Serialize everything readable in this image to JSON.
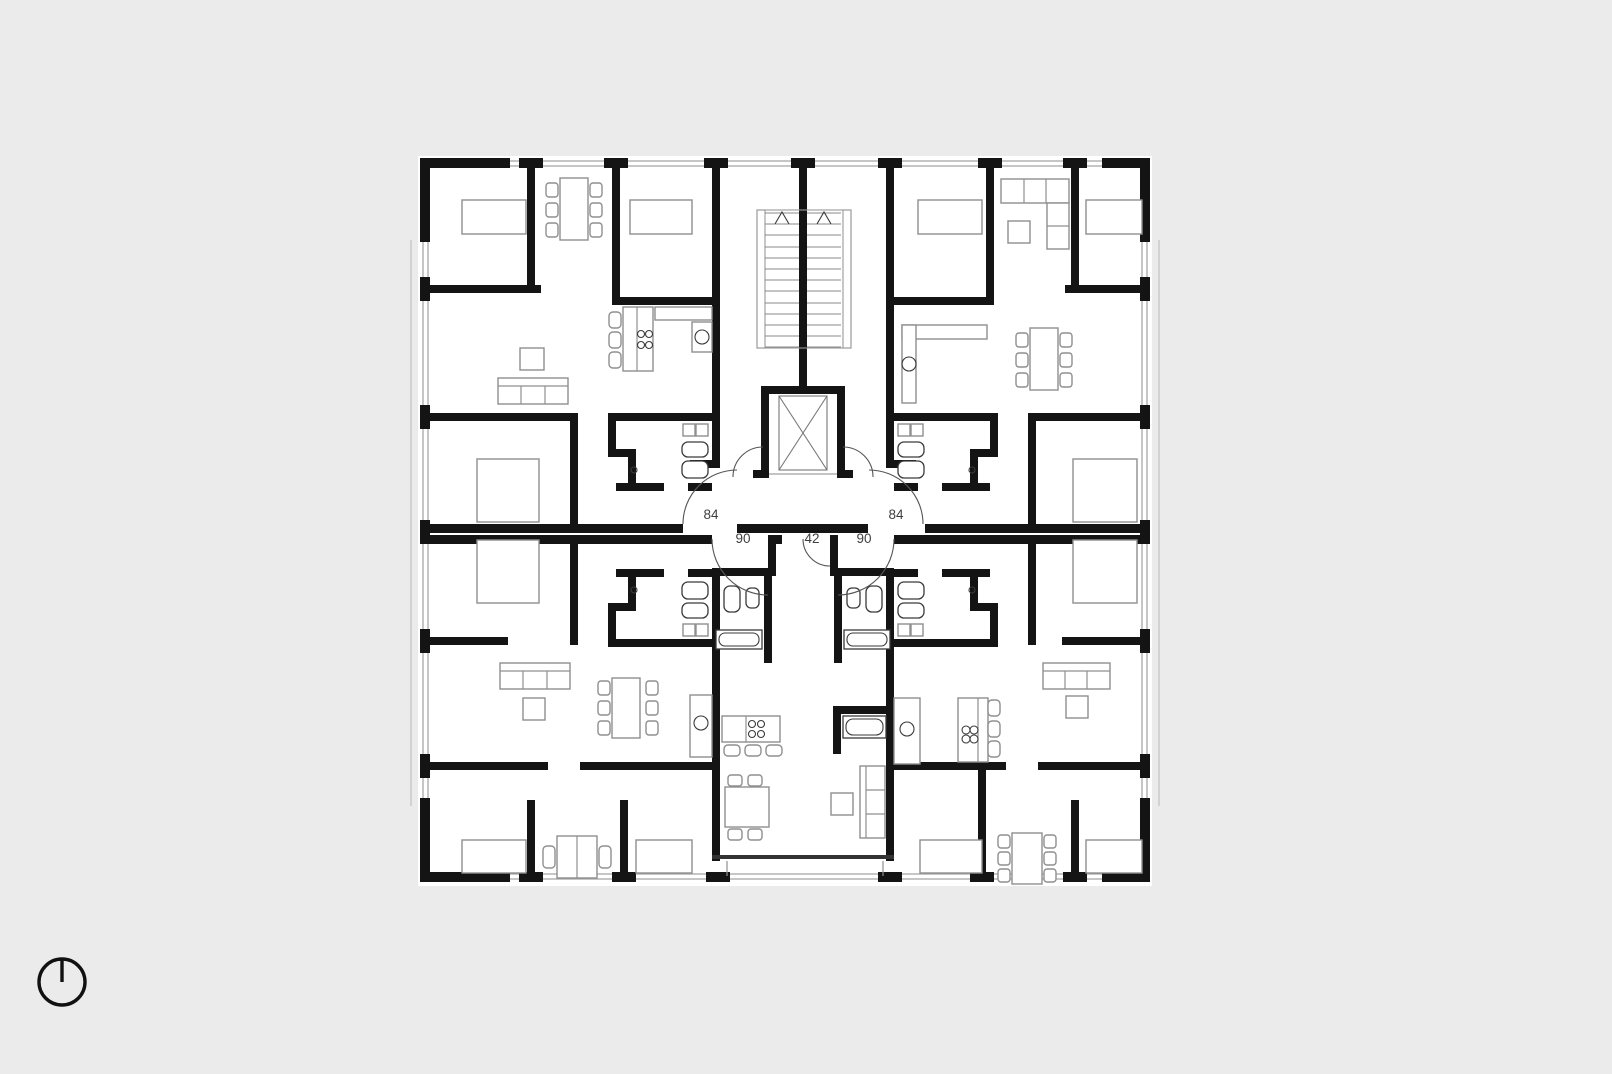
{
  "drawing": {
    "kind": "architectural floor plan",
    "description": "typical residential floor: four corner apartments, central double-run staircase with elevator, center studio with loggia"
  },
  "colors": {
    "background": "#ebebeb",
    "paper": "#ffffff",
    "wall": "#141414",
    "furniture": "#8f8f8f",
    "fixture": "#3a3a3a",
    "stair": "#8a8a8a",
    "window": "#a0a0a0",
    "door_arc": "#555555",
    "label": "#3f3f3f"
  },
  "annotations": {
    "dimensions": [
      {
        "value": "84",
        "x": 711,
        "y": 519
      },
      {
        "value": "84",
        "x": 896,
        "y": 519
      },
      {
        "value": "90",
        "x": 743,
        "y": 543
      },
      {
        "value": "42",
        "x": 812,
        "y": 543
      },
      {
        "value": "90",
        "x": 864,
        "y": 543
      }
    ]
  },
  "symbols": {
    "north_indicator": "north-arrow-circle",
    "elevator": "shaft-with-cross",
    "stair_direction": "up-chevrons"
  }
}
